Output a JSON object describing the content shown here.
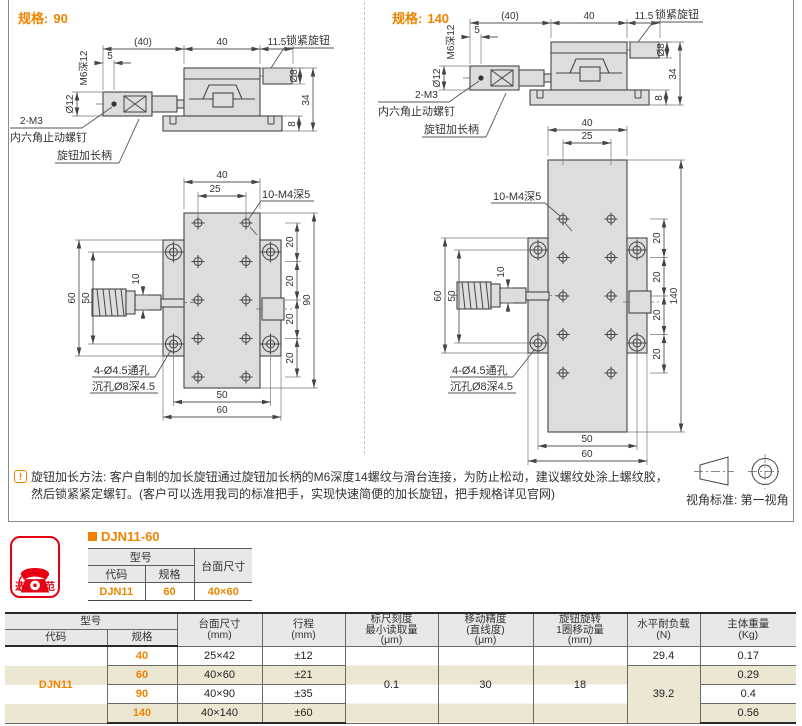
{
  "page": {
    "accent_orange": "#f08300",
    "badge_red": "#e60012",
    "stripe_beige": "#ece7d3"
  },
  "sections": {
    "left": {
      "spec_label": "规格:",
      "spec_value": "90"
    },
    "right": {
      "spec_label": "规格:",
      "spec_value": "140"
    }
  },
  "drawing_labels": {
    "paren40": "(40)",
    "d40": "40",
    "d115": "11.5",
    "lock_knob": "锁紧旋钮",
    "m6_depth": "M6深12",
    "d5": "5",
    "dia12": "Ø12",
    "two_m3": "2-M3",
    "set_screw": "内六角止动螺钉",
    "knob_handle": "旋钮加长柄",
    "dia8": "Ø8",
    "d34": "34",
    "d8": "8",
    "d25": "25",
    "holes_label": "10-M4深5",
    "d20": "20",
    "d90": "90",
    "d140": "140",
    "d60": "60",
    "d50": "50",
    "d10": "10",
    "thru_hole": "4-Ø4.5通孔",
    "cbore": "沉孔Ø8深4.5"
  },
  "note": {
    "icon": "!",
    "line1": "旋钮加长方法: 客户自制的加长旋钮通过旋钮加长柄的M6深度14螺纹与滑台连接，为防止松动，建议螺纹处涂上螺纹胶，",
    "line2": "然后锁紧紧定螺钉。(客户可以选用我司的标准把手，实现快速简便的加长旋钮，把手规格详见官网)",
    "view_standard": "视角标准: 第一视角"
  },
  "selection": {
    "badge_label": "选型示范",
    "title": "DJN11-60",
    "headers": {
      "model": "型号",
      "code": "代码",
      "spec": "规格",
      "size": "台面尺寸"
    },
    "values": {
      "code": "DJN11",
      "spec": "60",
      "size": "40×60"
    }
  },
  "spec_table": {
    "headers": {
      "model": "型号",
      "code": "代码",
      "spec": "规格",
      "size_l1": "台面尺寸",
      "size_l2": "(mm)",
      "stroke_l1": "行程",
      "stroke_l2": "(mm)",
      "scale_l1": "标尺刻度",
      "scale_l2": "最小读取量",
      "scale_l3": "(μm)",
      "acc_l1": "移动精度",
      "acc_l2": "(直线度)",
      "acc_l3": "(μm)",
      "turn_l1": "旋钮旋转",
      "turn_l2": "1圈移动量",
      "turn_l3": "(mm)",
      "load_l1": "水平耐负载",
      "load_l2": "(N)",
      "weight_l1": "主体重量",
      "weight_l2": "(Kg)"
    },
    "code_value": "DJN11",
    "rows": [
      {
        "spec": "40",
        "size": "25×42",
        "stroke": "±12",
        "weight": "0.17"
      },
      {
        "spec": "60",
        "size": "40×60",
        "stroke": "±21",
        "weight": "0.29"
      },
      {
        "spec": "90",
        "size": "40×90",
        "stroke": "±35",
        "weight": "0.4"
      },
      {
        "spec": "140",
        "size": "40×140",
        "stroke": "±60",
        "weight": "0.56"
      }
    ],
    "merged": {
      "scale_min": "0.1",
      "accuracy": "30",
      "move_per_turn": "18",
      "load_40": "29.4",
      "load_60_140": "39.2"
    }
  }
}
